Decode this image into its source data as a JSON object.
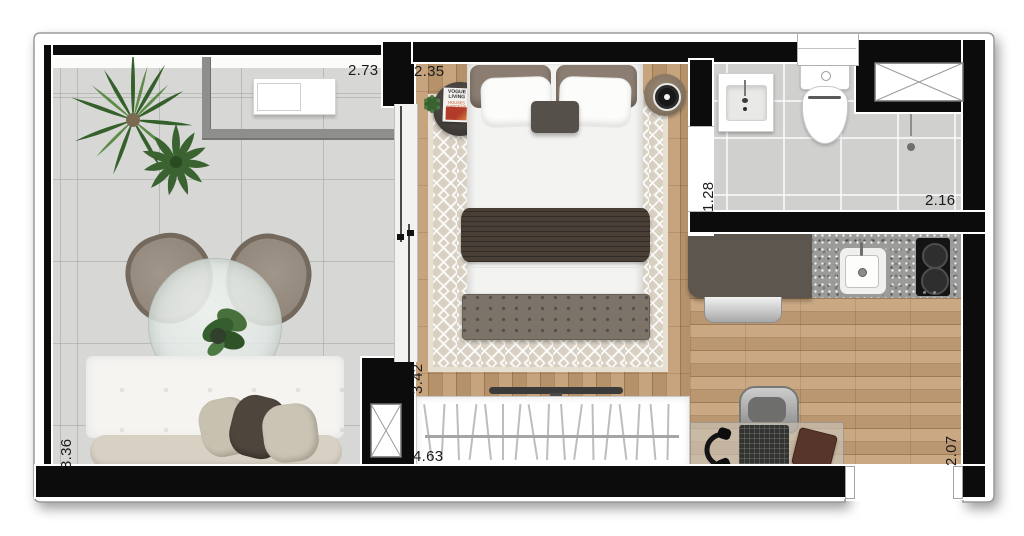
{
  "title": "Studio apartment floor plan",
  "dimensions": {
    "balcony_width": "2.73",
    "balcony_depth": "3.36",
    "bedroom_width": "2.35",
    "bedroom_depth": "3.42",
    "closet_width": "4.63",
    "bathroom_door_wall": "1.28",
    "bathroom_width": "2.16",
    "kitchen_depth": "2.07"
  },
  "decor": {
    "magazine_title": "VOGUE LIVING",
    "magazine_subtitle": "HOUSES GARDENS PEOPLE"
  },
  "colors": {
    "wall": "#0c0c0c",
    "wood_floor": "#c19b71",
    "tile_floor": "#d7d8d6",
    "rug": "#d8d0c2",
    "plant_green": "#3f6b33",
    "counter_dark": "#5d564f",
    "granite": "#9b9b99"
  }
}
